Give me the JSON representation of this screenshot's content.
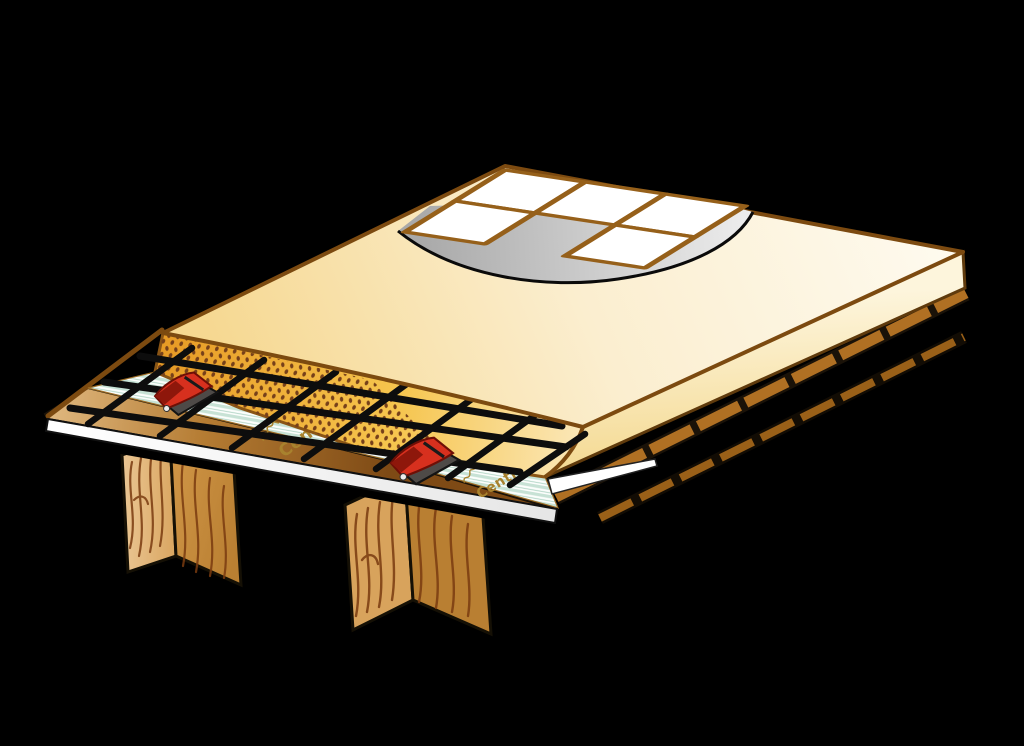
{
  "scene": {
    "description": "Cutaway technical illustration of a tiled floor build-up over timber joists",
    "layers_bottom_to_top": [
      "timber joists",
      "wooden subfloor board",
      "separating membrane",
      "red fixing clips",
      "steel reinforcement mesh",
      "levelling mortar / screed slab",
      "grey tile adhesive",
      "white ceramic tiles with brown grout"
    ]
  },
  "labels": {
    "membrane_brand_1": "Centro",
    "membrane_brand_2": "Centro"
  },
  "colors": {
    "background": "#000000",
    "screed_top": "#FBEDCB",
    "mortar_cut_face": "#F2B636",
    "mortar_dots": "#76401A",
    "membrane_stripe": "#C7E2D5",
    "mesh": "#0D0D0D",
    "clip_red": "#D7301E",
    "wood": "#D9A45B",
    "grout": "#96601A",
    "tile": "#FFFFFF",
    "adhesive_gray": "#C9C9C9",
    "outline_brown": "#7C4A10"
  }
}
